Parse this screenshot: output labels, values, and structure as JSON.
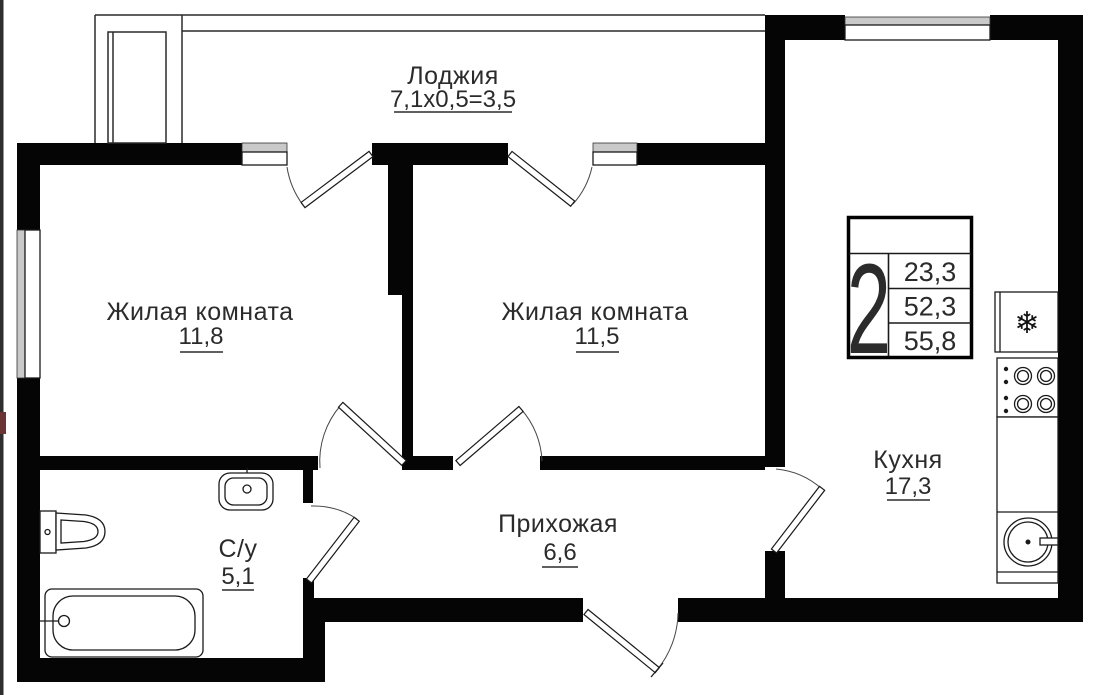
{
  "plan_type": "apartment-floor-plan",
  "rooms": {
    "loggia": {
      "name": "Лоджия",
      "dims": "7,1х0,5=3,5"
    },
    "living1": {
      "name": "Жилая комната",
      "area": "11,8"
    },
    "living2": {
      "name": "Жилая комната",
      "area": "11,5"
    },
    "kitchen": {
      "name": "Кухня",
      "area": "17,3"
    },
    "hallway": {
      "name": "Прихожая",
      "area": "6,6"
    },
    "bathroom": {
      "name": "С/у",
      "area": "5,1"
    }
  },
  "legend": {
    "rooms_count": "2",
    "living_area": "23,3",
    "apartment_area": "52,3",
    "total_area": "55,8"
  },
  "icons": {
    "freezer_symbol": "❄"
  },
  "colors": {
    "wall": "#050505",
    "window_fill": "#c9c9c9",
    "text": "#2b2b2b",
    "background": "#ffffff"
  }
}
